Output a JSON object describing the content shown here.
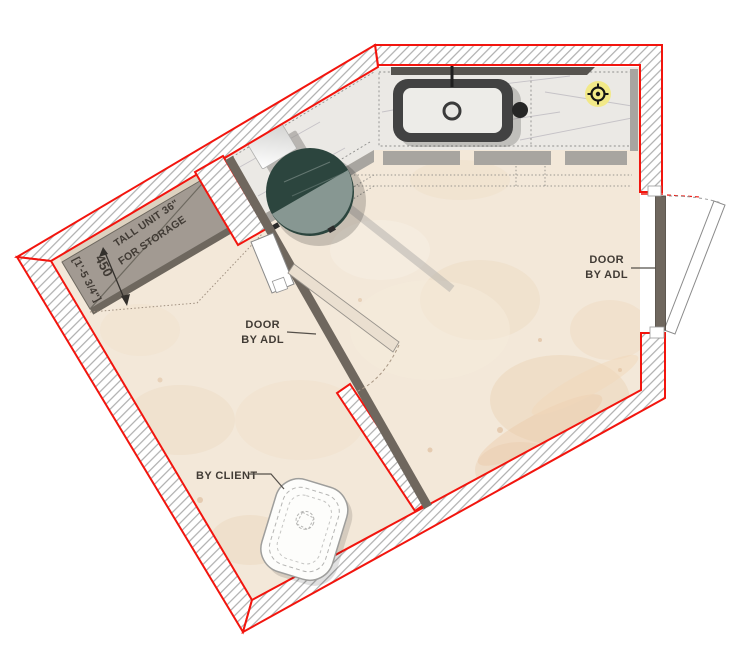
{
  "title": "Bathroom floor plan",
  "labels": {
    "tall_unit": {
      "line1": "TALL UNIT 36\"",
      "line2": "FOR STORAGE"
    },
    "tall_unit_dim": {
      "metric": "450",
      "imperial": "[1'-5 3/4\"]"
    },
    "interior_door": {
      "line1": "DOOR",
      "line2": "BY ADL"
    },
    "entry_door": {
      "line1": "DOOR",
      "line2": "BY ADL"
    },
    "toilet": {
      "label": "BY CLIENT"
    }
  },
  "colors": {
    "wall_outline_red": "#f2150e",
    "wall_hatch_gray": "#a6a6a6",
    "floor_beige": "#f3e8d9",
    "counter_marble": "#ebe9e5",
    "round_table_teal": "#2c453e",
    "door_panel_brown": "#6f675e",
    "light_glow_yellow": "#f3e97d",
    "tall_unit_gray": "#a29a92"
  },
  "icons": {
    "ceiling_light": "crosshair-light-symbol"
  }
}
